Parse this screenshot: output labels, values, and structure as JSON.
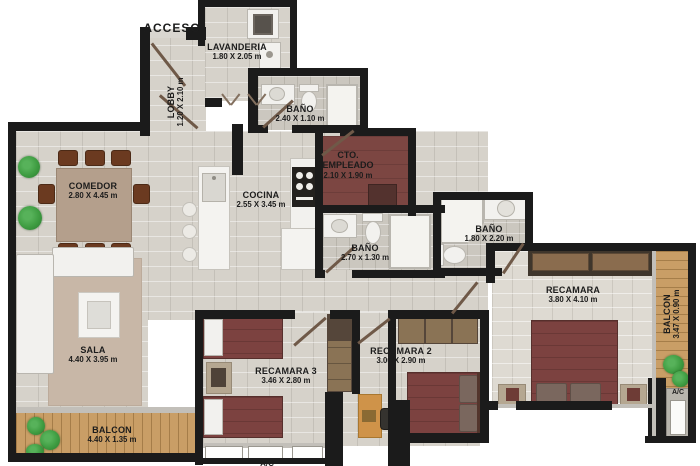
{
  "rooms": {
    "acceso": {
      "name": "ACCESO"
    },
    "lobby": {
      "name": "LOBBY",
      "dims": "1.20 X 2.10 m"
    },
    "lavanderia": {
      "name": "LAVANDERIA",
      "dims": "1.80 X 2.05 m"
    },
    "bano_top": {
      "name": "BAÑO",
      "dims": "2.40 X 1.10 m"
    },
    "cto_empleado": {
      "name": "CTO. EMPLEADO",
      "dims": "2.10 X 1.90 m"
    },
    "comedor": {
      "name": "COMEDOR",
      "dims": "2.80 X 4.45 m"
    },
    "cocina": {
      "name": "COCINA",
      "dims": "2.55 X 3.45 m"
    },
    "bano_medio": {
      "name": "BAÑO",
      "dims": "2.70 x 1.30 m"
    },
    "bano_principal": {
      "name": "BAÑO",
      "dims": "1.80 X 2.20 m"
    },
    "recamara_principal": {
      "name": "RECAMARA",
      "dims": "3.80 X 4.10 m"
    },
    "sala": {
      "name": "SALA",
      "dims": "4.40 X 3.95 m"
    },
    "recamara3": {
      "name": "RECAMARA 3",
      "dims": "3.46 X 2.80 m"
    },
    "recamara2": {
      "name": "RECAMARA 2",
      "dims": "3.00 X 2.90 m"
    },
    "balcon_sala": {
      "name": "BALCON",
      "dims": "4.40 X 1.35 m"
    },
    "balcon_recamara": {
      "name": "BALCON",
      "dims": "3.47 X 0.90 m"
    },
    "ac_recamara": {
      "name": "A/C"
    },
    "ac_recamara3": {
      "name": "A/C"
    }
  },
  "colors": {
    "wall": "#1b1b1b",
    "tile": "#d6d2ca",
    "tile_bath": "#cbc7bf",
    "wood_balcony": "#c99e66",
    "bed_red": "#7c4240",
    "empleado_floor": "#7c4642",
    "closet_wood": "#8a7355",
    "rug": "#c8b7a7",
    "desk_orange": "#cf9349",
    "plant_green": "#3f9d42"
  }
}
